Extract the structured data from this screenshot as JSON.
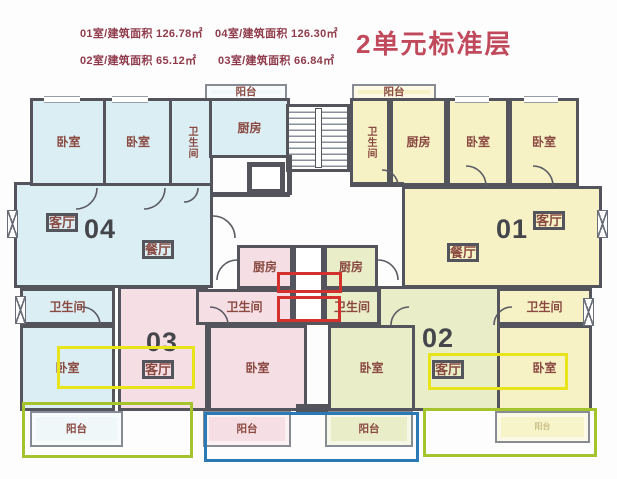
{
  "header": {
    "title": "2单元标准层",
    "areas": [
      {
        "label": "01室/建筑面积 126.78㎡",
        "x": 80,
        "y": 25
      },
      {
        "label": "04室/建筑面积 126.30㎡",
        "x": 215,
        "y": 25
      },
      {
        "label": "02室/建筑面积 65.12㎡",
        "x": 80,
        "y": 52
      },
      {
        "label": "03室/建筑面积 66.84㎡",
        "x": 218,
        "y": 52
      }
    ]
  },
  "legend_colors": {
    "unit01": "#f7f2c6",
    "unit02": "#e9eec9",
    "unit03": "#f6dfe4",
    "unit04": "#daeef3",
    "wall": "#54545c",
    "room_label": "#8a4a42",
    "unit_number": "#45454c",
    "header_label": "#8f3b4b",
    "title_red": "#c0495c",
    "annotation_red": "#d2312e",
    "annotation_yellow": "#e8e41c",
    "annotation_green": "#a4c32c",
    "annotation_blue": "#2a7ab5"
  },
  "plan": {
    "rooms": [
      {
        "unit": "04",
        "name": "living-room",
        "label": "",
        "x": 14,
        "y": 182,
        "w": 199,
        "h": 106
      },
      {
        "unit": "01",
        "name": "living-room",
        "label": "",
        "x": 402,
        "y": 186,
        "w": 200,
        "h": 102
      },
      {
        "unit": "03",
        "name": "living-room",
        "label": "",
        "x": 118,
        "y": 286,
        "w": 90,
        "h": 125
      },
      {
        "unit": "02",
        "name": "living-room",
        "label": "",
        "x": 378,
        "y": 286,
        "w": 122,
        "h": 125
      },
      {
        "unit": "04",
        "name": "bedroom-1",
        "label": "卧室",
        "x": 30,
        "y": 98,
        "w": 77,
        "h": 88
      },
      {
        "unit": "04",
        "name": "bedroom-2",
        "label": "卧室",
        "x": 103,
        "y": 98,
        "w": 70,
        "h": 88
      },
      {
        "unit": "04",
        "name": "bathroom-top",
        "label": "卫生间",
        "vertical": true,
        "x": 169,
        "y": 98,
        "w": 44,
        "h": 88
      },
      {
        "unit": "04",
        "name": "kitchen",
        "label": "厨房",
        "x": 209,
        "y": 98,
        "w": 81,
        "h": 60
      },
      {
        "unit": "04",
        "name": "bathroom-bottom",
        "label": "卫生间",
        "x": 20,
        "y": 288,
        "w": 95,
        "h": 37
      },
      {
        "unit": "04",
        "name": "bedroom-3",
        "label": "卧室",
        "x": 20,
        "y": 325,
        "w": 95,
        "h": 86
      },
      {
        "unit": "04",
        "name": "balcony-top",
        "label": "阳台",
        "balcony": true,
        "bg": "#eff7f9",
        "x": 205,
        "y": 84,
        "w": 82,
        "h": 16
      },
      {
        "unit": "04",
        "name": "balcony-bottom",
        "label": "阳台",
        "balcony": true,
        "bg": "#f0f7f8",
        "x": 30,
        "y": 411,
        "w": 93,
        "h": 36
      },
      {
        "unit": "01",
        "name": "balcony-top",
        "label": "阳台",
        "balcony": true,
        "bg": "#f7f2c6",
        "x": 352,
        "y": 84,
        "w": 84,
        "h": 16
      },
      {
        "unit": "01",
        "name": "bathroom-top",
        "label": "卫生间",
        "vertical": true,
        "x": 350,
        "y": 98,
        "w": 40,
        "h": 88
      },
      {
        "unit": "01",
        "name": "kitchen",
        "label": "厨房",
        "x": 390,
        "y": 98,
        "w": 57,
        "h": 88
      },
      {
        "unit": "01",
        "name": "bedroom-1",
        "label": "卧室",
        "x": 447,
        "y": 98,
        "w": 62,
        "h": 88
      },
      {
        "unit": "01",
        "name": "bedroom-2",
        "label": "卧室",
        "x": 509,
        "y": 98,
        "w": 70,
        "h": 88
      },
      {
        "unit": "01",
        "name": "bathroom-bottom",
        "label": "卫生间",
        "x": 497,
        "y": 288,
        "w": 95,
        "h": 37
      },
      {
        "unit": "01",
        "name": "bedroom-3",
        "label": "卧室",
        "x": 497,
        "y": 325,
        "w": 95,
        "h": 86
      },
      {
        "unit": "01",
        "name": "balcony-bottom",
        "label": "阳台",
        "balcony": true,
        "tiny": true,
        "bg": "#f8f4c9",
        "x": 495,
        "y": 411,
        "w": 95,
        "h": 32
      },
      {
        "unit": "03",
        "name": "kitchen",
        "label": "厨房",
        "x": 237,
        "y": 245,
        "w": 56,
        "h": 44
      },
      {
        "unit": "03",
        "name": "bathroom",
        "label": "卫生间",
        "x": 196,
        "y": 289,
        "w": 97,
        "h": 36
      },
      {
        "unit": "03",
        "name": "bedroom",
        "label": "卧室",
        "x": 208,
        "y": 325,
        "w": 99,
        "h": 86
      },
      {
        "unit": "03",
        "name": "balcony",
        "label": "阳台",
        "balcony": true,
        "bg": "#f6dfe4",
        "x": 203,
        "y": 411,
        "w": 88,
        "h": 36
      },
      {
        "unit": "02",
        "name": "kitchen",
        "label": "厨房",
        "x": 324,
        "y": 245,
        "w": 54,
        "h": 44
      },
      {
        "unit": "02",
        "name": "bathroom",
        "label": "卫生间",
        "x": 324,
        "y": 289,
        "w": 56,
        "h": 36
      },
      {
        "unit": "02",
        "name": "bedroom",
        "label": "卧室",
        "x": 328,
        "y": 325,
        "w": 87,
        "h": 86
      },
      {
        "unit": "02",
        "name": "balcony",
        "label": "阳台",
        "balcony": true,
        "bg": "#e9eec9",
        "x": 325,
        "y": 411,
        "w": 88,
        "h": 36
      }
    ],
    "texts": [
      {
        "text": "客厅",
        "x": 46,
        "y": 213,
        "cls": "room"
      },
      {
        "text": "04",
        "x": 84,
        "y": 216,
        "cls": "unit"
      },
      {
        "text": "餐厅",
        "x": 142,
        "y": 240,
        "cls": "room"
      },
      {
        "text": "餐厅",
        "x": 447,
        "y": 243,
        "cls": "room"
      },
      {
        "text": "01",
        "x": 496,
        "y": 216,
        "cls": "unit"
      },
      {
        "text": "客厅",
        "x": 533,
        "y": 211,
        "cls": "room"
      },
      {
        "text": "03",
        "x": 146,
        "y": 329,
        "cls": "unit"
      },
      {
        "text": "客厅",
        "x": 142,
        "y": 360,
        "cls": "room"
      },
      {
        "text": "02",
        "x": 422,
        "y": 325,
        "cls": "unit"
      },
      {
        "text": "客厅",
        "x": 432,
        "y": 360,
        "cls": "room"
      }
    ],
    "annotations": [
      {
        "color": "red",
        "x": 277,
        "y": 272,
        "w": 65,
        "h": 21
      },
      {
        "color": "red",
        "x": 277,
        "y": 296,
        "w": 64,
        "h": 26
      },
      {
        "color": "yellow",
        "x": 57,
        "y": 346,
        "w": 138,
        "h": 43
      },
      {
        "color": "yellow",
        "x": 428,
        "y": 353,
        "w": 140,
        "h": 37
      },
      {
        "color": "green",
        "x": 22,
        "y": 402,
        "w": 171,
        "h": 56
      },
      {
        "color": "green",
        "x": 423,
        "y": 408,
        "w": 174,
        "h": 49
      },
      {
        "color": "blue",
        "x": 204,
        "y": 412,
        "w": 215,
        "h": 50
      }
    ],
    "walls": [
      {
        "x": 213,
        "y": 192,
        "w": 77,
        "h": 5
      },
      {
        "x": 350,
        "y": 182,
        "w": 54,
        "h": 5
      },
      {
        "x": 287,
        "y": 155,
        "w": 5,
        "h": 40
      },
      {
        "x": 296,
        "y": 404,
        "w": 32,
        "h": 9
      }
    ],
    "fixtures": {
      "shaft": {
        "x": 293,
        "y": 245,
        "w": 31,
        "h": 80
      },
      "stairs": {
        "x": 286,
        "y": 104,
        "w": 64,
        "h": 68
      },
      "rail": {
        "x": 315,
        "y": 108,
        "w": 7,
        "h": 60
      },
      "elevator": {
        "x": 247,
        "y": 162,
        "w": 38,
        "h": 32
      },
      "windows": [
        {
          "x": 7,
          "y": 210,
          "w": 11,
          "h": 28
        },
        {
          "x": 15,
          "y": 296,
          "w": 11,
          "h": 28
        },
        {
          "x": 597,
          "y": 210,
          "w": 11,
          "h": 28
        },
        {
          "x": 583,
          "y": 298,
          "w": 11,
          "h": 28
        }
      ],
      "window_gaps": [
        {
          "x": 44,
          "y": 96,
          "w": 36
        },
        {
          "x": 112,
          "y": 96,
          "w": 36
        },
        {
          "x": 455,
          "y": 96,
          "w": 34
        },
        {
          "x": 524,
          "y": 96,
          "w": 34
        }
      ]
    }
  }
}
